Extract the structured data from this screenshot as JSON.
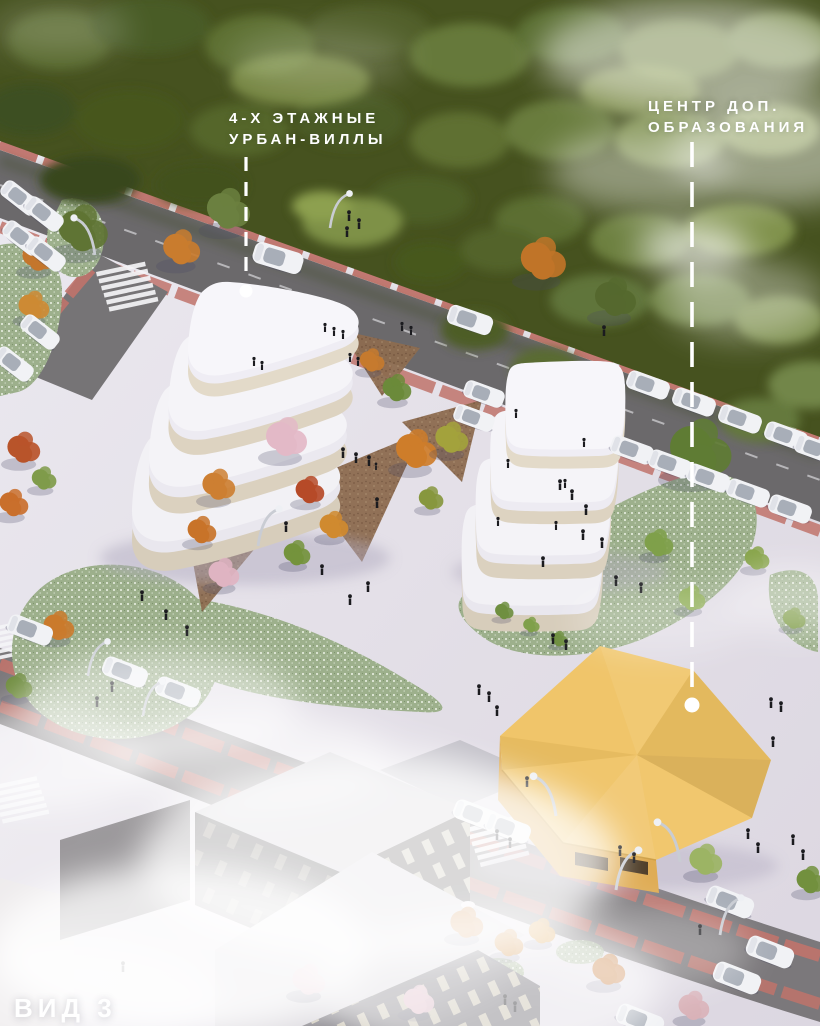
{
  "annotations": {
    "villas": {
      "line1": "4-Х ЭТАЖНЫЕ",
      "line2": "УРБАН-ВИЛЛЫ"
    },
    "education": {
      "line1": "ЦЕНТР ДОП.",
      "line2": "ОБРАЗОВАНИЯ"
    }
  },
  "view_label": "ВИД 3",
  "colors": {
    "annotation-text": "#ffffff",
    "education-roof": "#f0c364",
    "education-wall": "#dfac54",
    "villa-white": "#f7f6fa",
    "villa-band": "#ddd3c1",
    "red-lane": "#c0736b",
    "asphalt": "#6f6d6f",
    "plaza": "#e4e0e8",
    "lawn-green": "#9db08c",
    "forest-green": "#46521f",
    "autumn-orange": "#cd7c2e",
    "fog": "#ffffff"
  }
}
